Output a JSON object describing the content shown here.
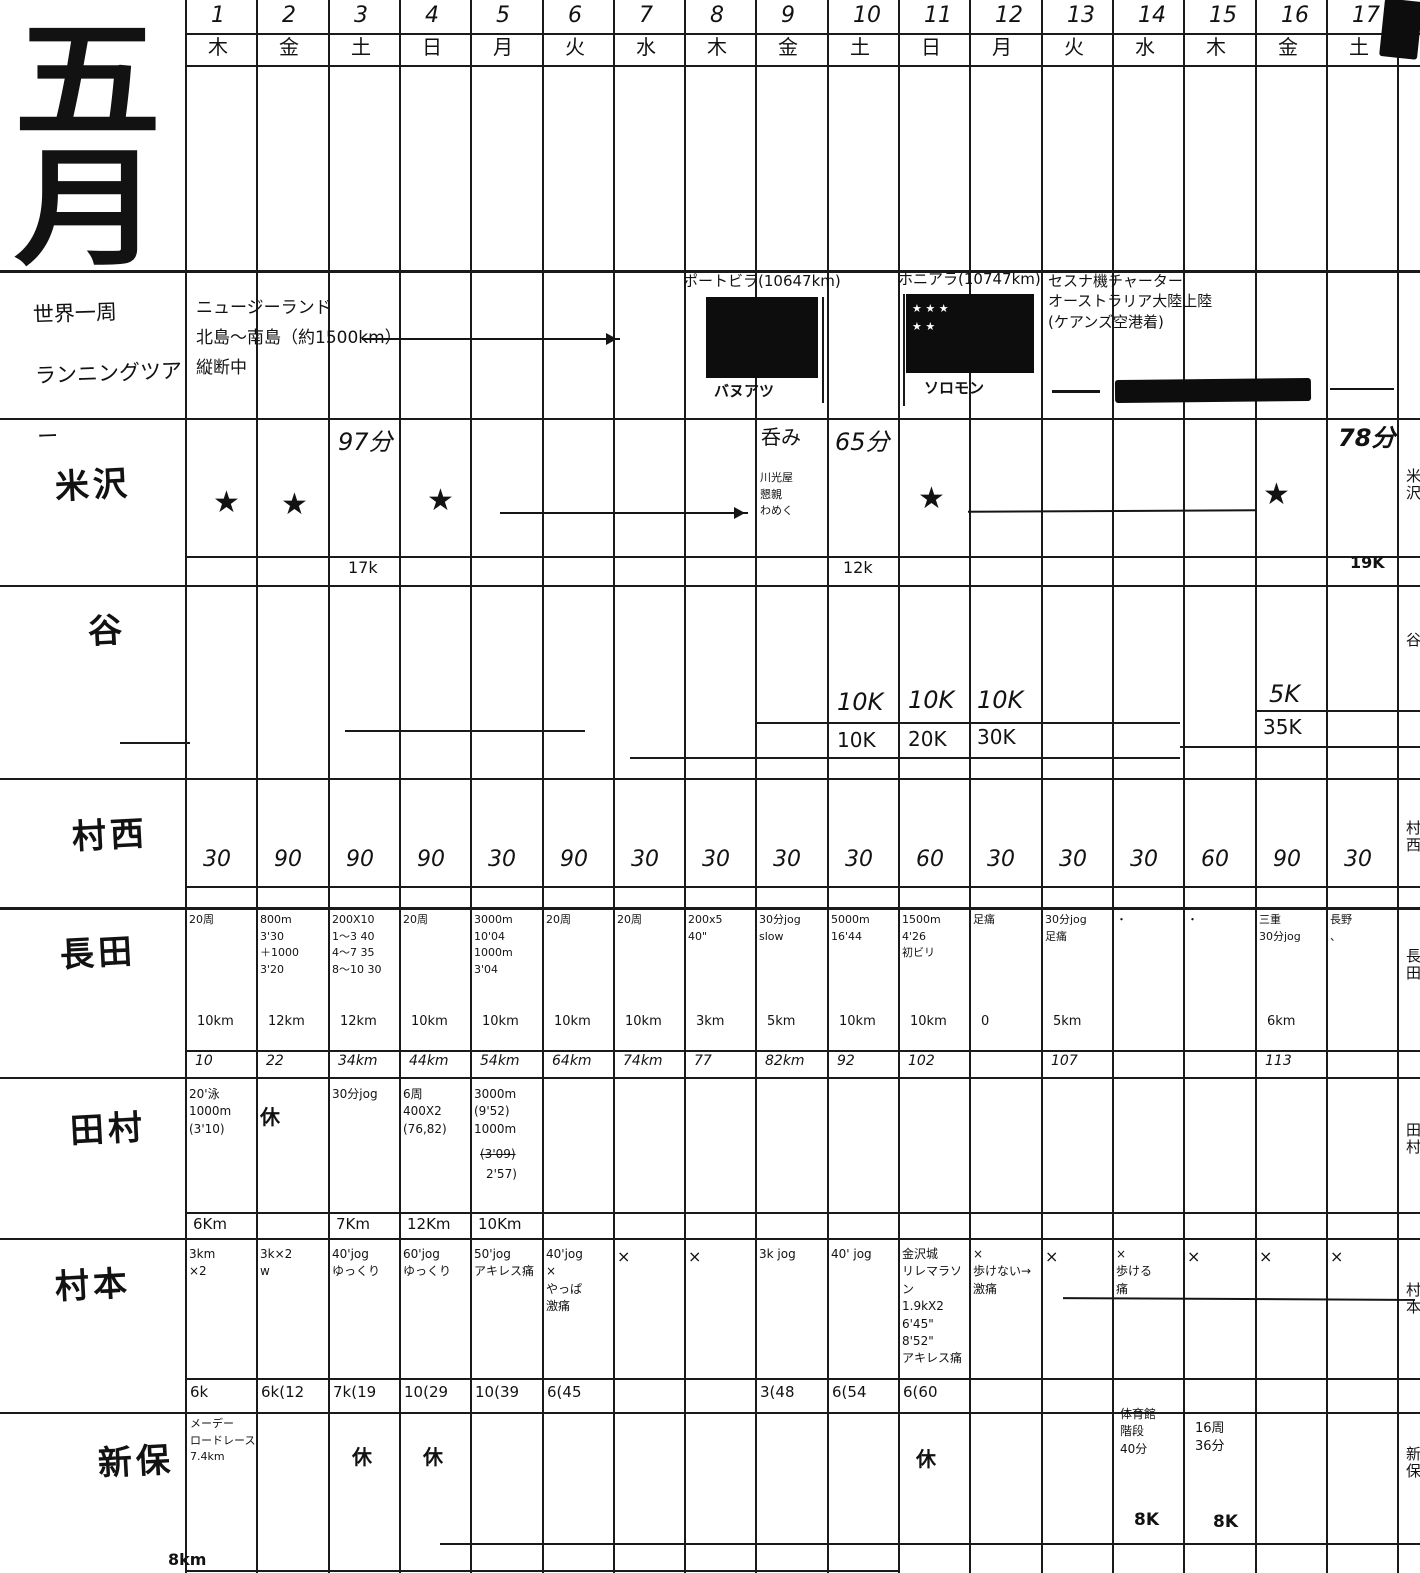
{
  "month_title": "五\n月",
  "dates": [
    "1",
    "2",
    "3",
    "4",
    "5",
    "6",
    "7",
    "8",
    "9",
    "10",
    "11",
    "12",
    "13",
    "14",
    "15",
    "16",
    "17"
  ],
  "weekdays": [
    "木",
    "金",
    "土",
    "日",
    "月",
    "火",
    "水",
    "木",
    "金",
    "土",
    "日",
    "月",
    "火",
    "水",
    "木",
    "金",
    "土"
  ],
  "left_labels": {
    "tour": "世界一周\nランニングツアー",
    "yonezawa": "米沢",
    "tani": "谷",
    "muranishi": "村西",
    "nagata": "長田",
    "tamura": "田村",
    "muramoto": "村本",
    "shinbo": "新保"
  },
  "right_labels": {
    "yonezawa": "米沢",
    "tani": "谷",
    "muranishi": "村西",
    "nagata": "長田",
    "tamura": "田村",
    "muramoto": "村本",
    "shinbo": "新保"
  },
  "tour": {
    "route": "ニュージーランド\n北島〜南島（約1500km）\n縦断中",
    "flag1_caption": "ポートビラ(10647km)",
    "flag1_country": "バヌアツ",
    "flag2_caption": "ホニアラ(10747km)",
    "flag2_country": "ソロモン",
    "flag2_stars": "★ ★ ★\n ★ ★",
    "charter_note": "セスナ機チャーター\nオーストラリア大陸上陸\n(ケアンズ空港着)"
  },
  "yonezawa": {
    "d1": "★",
    "d2": "★",
    "d4": "★",
    "d11": "★",
    "d16": "★",
    "d3_top": "97分",
    "d3_bottom": "17k",
    "d9_top": "呑み",
    "d9_note": "川光屋\n懇親\nわめく",
    "d10_top": "65分",
    "d10_bottom": "12k",
    "d17_top": "78分",
    "d17_bottom": "19K"
  },
  "tani": {
    "d10": "10K",
    "d10_cum": "10K",
    "d11": "10K",
    "d11_cum": "20K",
    "d12": "10K",
    "d12_cum": "30K",
    "d16": "5K",
    "d16_cum": "35K"
  },
  "muranishi": {
    "values": [
      "30",
      "90",
      "90",
      "90",
      "30",
      "90",
      "30",
      "30",
      "30",
      "30",
      "60",
      "30",
      "30",
      "30",
      "60",
      "90",
      "30"
    ]
  },
  "nagata": {
    "days": [
      {
        "main": "20周",
        "km": "10km",
        "cum": "10"
      },
      {
        "main": "800m\n3'30\n＋1000\n3'20",
        "km": "12km",
        "cum": "22"
      },
      {
        "main": "200X10\n1〜3 40\n4〜7 35\n8〜10 30",
        "km": "12km",
        "cum": "34km"
      },
      {
        "main": "20周",
        "km": "10km",
        "cum": "44km"
      },
      {
        "main": "3000m\n10'04\n1000m\n3'04",
        "km": "10km",
        "cum": "54km"
      },
      {
        "main": "20周",
        "km": "10km",
        "cum": "64km"
      },
      {
        "main": "20周",
        "km": "10km",
        "cum": "74km"
      },
      {
        "main": "200x5\n40\"",
        "km": "3km",
        "cum": "77"
      },
      {
        "main": "30分jog\nslow",
        "km": "5km",
        "cum": "82km"
      },
      {
        "main": "5000m\n16'44",
        "km": "10km",
        "cum": "92"
      },
      {
        "main": "1500m\n4'26\n初ビリ",
        "km": "10km",
        "cum": "102"
      },
      {
        "main": "足痛",
        "km": "0",
        "cum": ""
      },
      {
        "main": "30分jog\n足痛",
        "km": "5km",
        "cum": "107"
      },
      {
        "main": "・",
        "km": "",
        "cum": ""
      },
      {
        "main": "・",
        "km": "",
        "cum": ""
      },
      {
        "main": "三重\n30分jog",
        "km": "6km",
        "cum": "113"
      },
      {
        "main": "長野\n、",
        "km": "",
        "cum": ""
      }
    ]
  },
  "tamura": {
    "days": [
      {
        "main": "20'泳\n1000m\n(3'10)",
        "km": "6Km"
      },
      {
        "main": "休",
        "km": ""
      },
      {
        "main": "30分jog",
        "km": "7Km"
      },
      {
        "main": "6周\n400X2\n(76,82)",
        "km": "12Km"
      },
      {
        "main": "3000m\n(9'52)\n1000m",
        "km": "10Km",
        "strike": "(3'09)",
        "tail": "2'57)"
      }
    ]
  },
  "muramoto": {
    "days": [
      {
        "main": "3km\n×2",
        "cum": "6k"
      },
      {
        "main": "3k×2\nw",
        "cum": "6k(12"
      },
      {
        "main": "40'jog\nゆっくり",
        "cum": "7k(19"
      },
      {
        "main": "60'jog\nゆっくり",
        "cum": "10(29"
      },
      {
        "main": "50'jog\nアキレス痛",
        "cum": "10(39"
      },
      {
        "main": "40'jog\n×\nやっぱ\n激痛",
        "cum": "6(45"
      },
      {
        "main": "×",
        "cum": ""
      },
      {
        "main": "×",
        "cum": ""
      },
      {
        "main": "3k jog",
        "cum": "3(48"
      },
      {
        "main": "40' jog",
        "cum": "6(54"
      },
      {
        "main": "金沢城\nリレマラソン\n1.9kX2\n6'45\"\n8'52\"\nアキレス痛",
        "cum": "6(60"
      },
      {
        "main": "×\n歩けない→\n激痛",
        "cum": ""
      },
      {
        "main": "×",
        "cum": ""
      },
      {
        "main": "×\n歩ける\n痛",
        "cum": ""
      },
      {
        "main": "×",
        "cum": ""
      },
      {
        "main": "×",
        "cum": ""
      },
      {
        "main": "×",
        "cum": ""
      }
    ]
  },
  "shinbo": {
    "d1": "メーデー\nロードレース\n7.4km",
    "d3": "休",
    "d4": "休",
    "d11": "休",
    "d14": "体育館\n階段\n40分",
    "d14_cum": "8K",
    "d15": "16周\n36分",
    "d15_cum": "8K",
    "bottom_partial": "8km"
  }
}
